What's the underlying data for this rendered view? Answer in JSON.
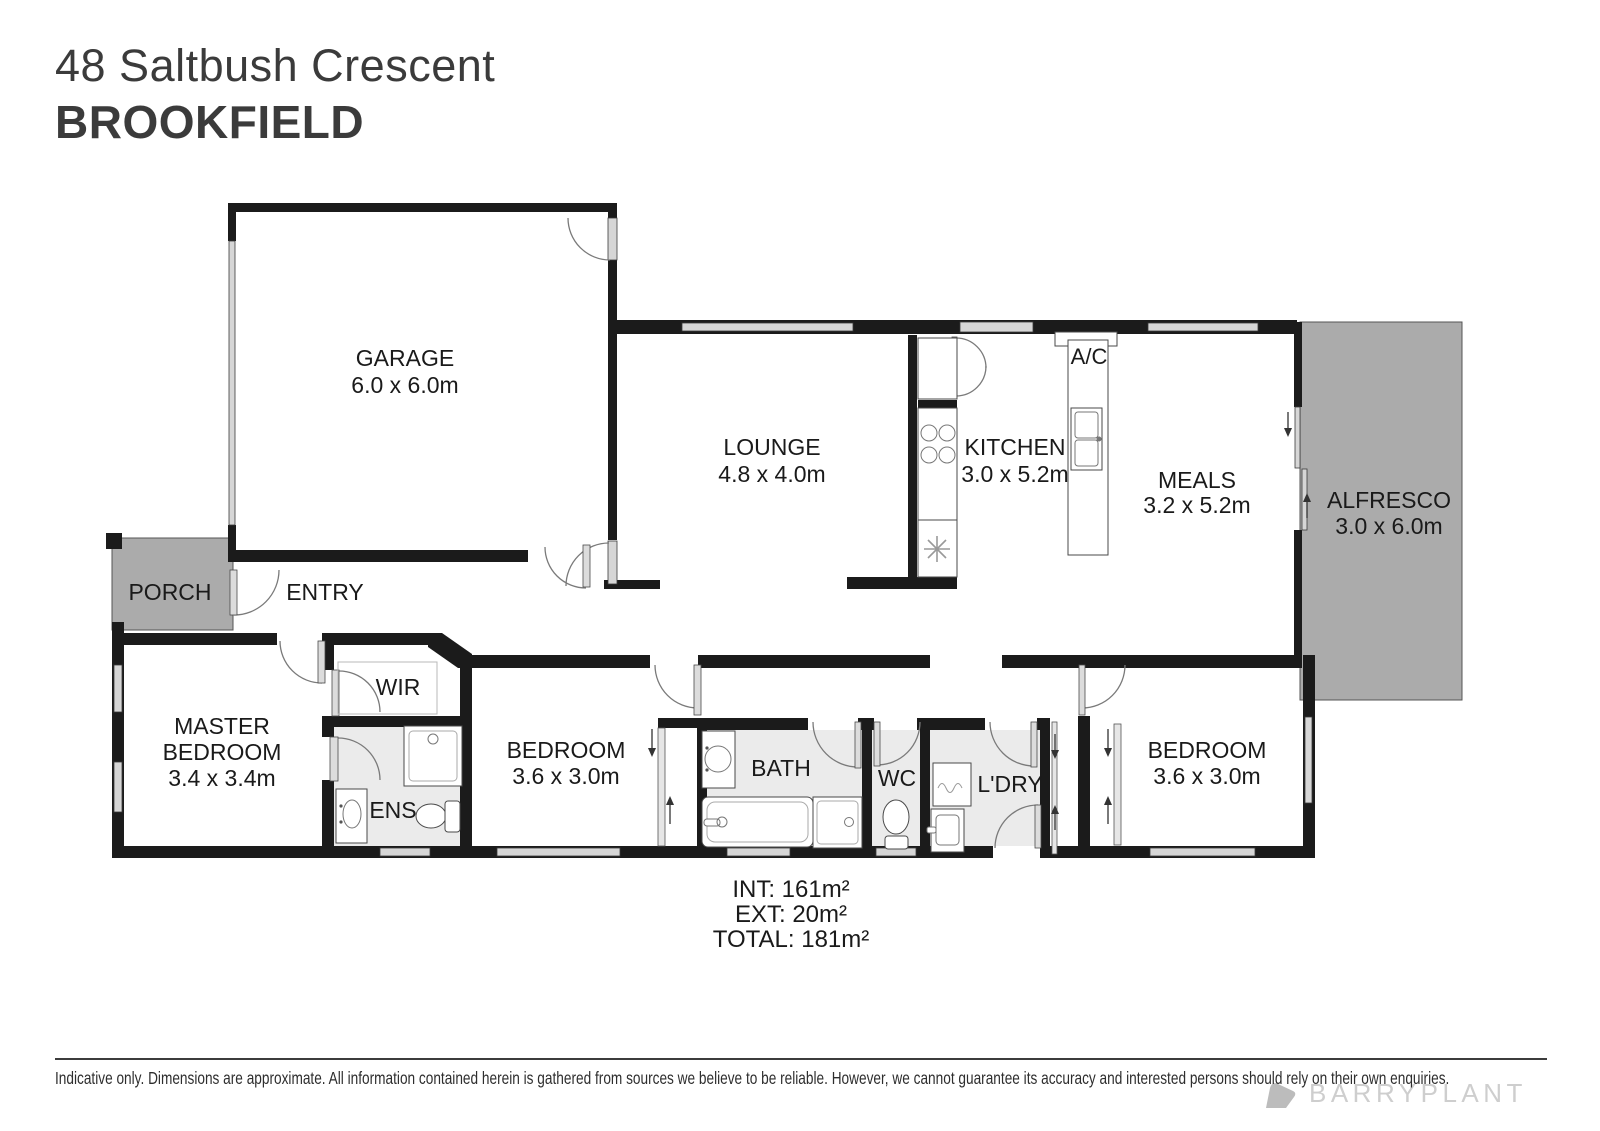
{
  "header": {
    "address": "48 Saltbush Crescent",
    "suburb": "BROOKFIELD"
  },
  "plan": {
    "rooms": {
      "garage": {
        "name": "GARAGE",
        "dims": "6.0 x 6.0m"
      },
      "lounge": {
        "name": "LOUNGE",
        "dims": "4.8 x 4.0m"
      },
      "kitchen": {
        "name": "KITCHEN",
        "dims": "3.0 x 5.2m"
      },
      "meals": {
        "name": "MEALS",
        "dims": "3.2 x 5.2m"
      },
      "alfresco": {
        "name": "ALFRESCO",
        "dims": "3.0 x 6.0m"
      },
      "master": {
        "line1": "MASTER",
        "line2": "BEDROOM",
        "dims": "3.4 x 3.4m"
      },
      "bedroom2": {
        "name": "BEDROOM",
        "dims": "3.6 x 3.0m"
      },
      "bedroom3": {
        "name": "BEDROOM",
        "dims": "3.6 x 3.0m"
      },
      "porch": {
        "name": "PORCH"
      },
      "entry": {
        "name": "ENTRY"
      },
      "wir": {
        "name": "WIR"
      },
      "ens": {
        "name": "ENS"
      },
      "bath": {
        "name": "BATH"
      },
      "wc": {
        "name": "WC"
      },
      "laundry": {
        "name": "L'DRY"
      },
      "ac": {
        "name": "A/C"
      }
    },
    "areas": {
      "internal": "INT: 161m²",
      "external": "EXT: 20m²",
      "total": "TOTAL: 181m²"
    }
  },
  "footer": {
    "disclaimer": "Indicative only. Dimensions are approximate. All information contained herein is gathered from sources we believe to be reliable. However, we cannot guarantee its accuracy and interested persons should rely on their own enquiries.",
    "brand": "BARRYPLANT"
  },
  "colors": {
    "wall": "#1b1b1b",
    "outdoor": "#ababab",
    "wet_area": "#ebebeb",
    "window": "#d6d6d6",
    "brand_gray": "#cecece",
    "text": "#1a1a1a"
  }
}
